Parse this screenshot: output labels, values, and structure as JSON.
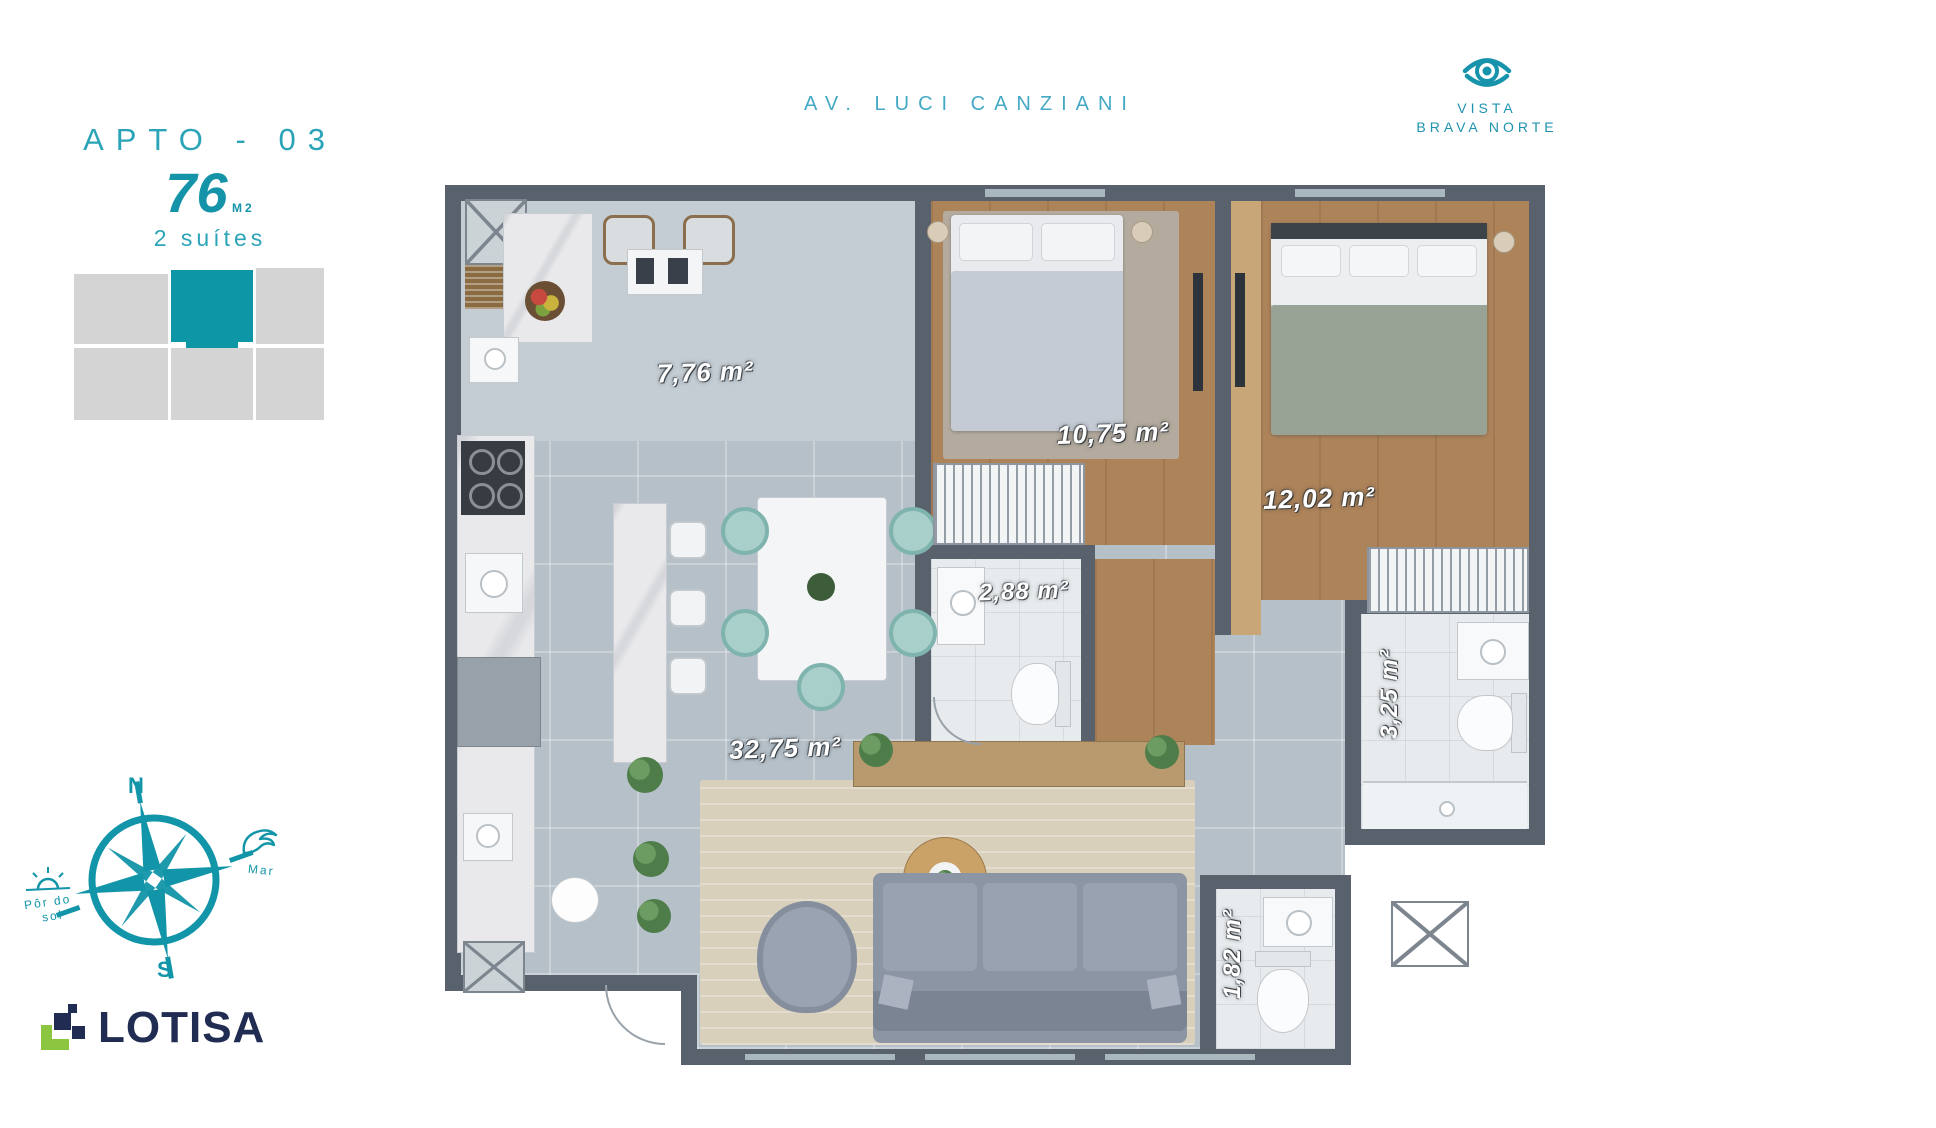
{
  "header": {
    "apto": "APTO - 03",
    "area": "76",
    "area_unit": "M2",
    "suites": "2 suítes"
  },
  "top": {
    "street": "AV. LUCI CANZIANI",
    "vista_line1": "VISTA",
    "vista_line2": "BRAVA NORTE",
    "vista_icon": "eye-icon"
  },
  "compass": {
    "north": "N",
    "south": "S",
    "sunset_line1": "Pôr do",
    "sunset_line2": "sol",
    "sea": "Mar",
    "icons": [
      "compass-rose-icon",
      "sun-icon",
      "wave-icon"
    ]
  },
  "logo": {
    "name": "LOTISA",
    "icon": "pixel-steps-icon",
    "navy": "#202c52",
    "green": "#8cc540"
  },
  "keyplan": {
    "highlight_color": "#0d96a6",
    "block_color": "#d4d4d4",
    "highlighted_unit": "APTO 03"
  },
  "floorplan": {
    "wall_color": "#59616c",
    "accent_teal": "#1295a8",
    "rooms": [
      {
        "id": "kitchen",
        "area": "7,76 m²"
      },
      {
        "id": "suite-1",
        "area": "10,75 m²"
      },
      {
        "id": "suite-2",
        "area": "12,02 m²"
      },
      {
        "id": "bathroom-suite-1",
        "area": "2,88 m²"
      },
      {
        "id": "bathroom-suite-2",
        "area": "3,25 m²"
      },
      {
        "id": "living-dining",
        "area": "32,75 m²"
      },
      {
        "id": "lavabo",
        "area": "1,82 m²"
      }
    ]
  }
}
